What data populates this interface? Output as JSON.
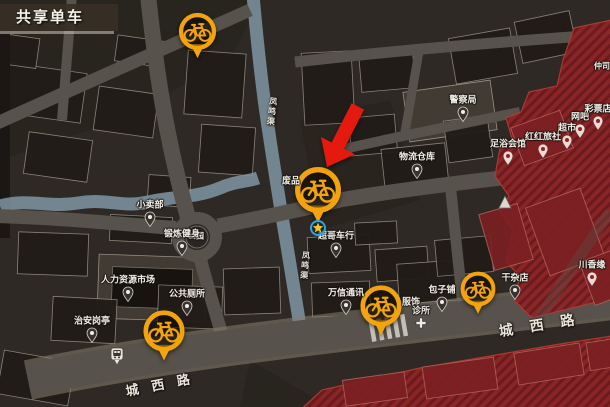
{
  "title": "共享单车",
  "colors": {
    "map_bg": "#2e2925",
    "road": "#57524b",
    "water": "#7e95a3",
    "label_text": "#f2efe9",
    "accent_pin": "#f2a30e",
    "danger_zone": "#8e2428",
    "danger_stripe": "#6f1a1e",
    "arrow_red": "#e41a0f",
    "star_yellow": "#f7c61c",
    "star_ring_blue": "#35a3dc"
  },
  "bike_pins": [
    {
      "x": 197,
      "y": 31,
      "s": 17
    },
    {
      "x": 318,
      "y": 190,
      "s": 21
    },
    {
      "x": 164,
      "y": 331,
      "s": 19
    },
    {
      "x": 381,
      "y": 306,
      "s": 19
    },
    {
      "x": 478,
      "y": 289,
      "s": 16
    }
  ],
  "player_marker": {
    "x": 318,
    "y": 228
  },
  "arrow": {
    "tip_x": 327,
    "tip_y": 167,
    "rotation": 27
  },
  "poi": [
    {
      "label": "警察局",
      "x": 463,
      "y": 121,
      "pin": "dark"
    },
    {
      "label": "物流仓库",
      "x": 417,
      "y": 178,
      "pin": "dark"
    },
    {
      "label": "小卖部",
      "x": 150,
      "y": 226,
      "pin": "dark"
    },
    {
      "label": "公园",
      "x": 196,
      "y": 236,
      "pin": "none",
      "small": true
    },
    {
      "label": "锻炼健身",
      "x": 182,
      "y": 255,
      "pin": "dark"
    },
    {
      "label": "人力资源市场",
      "x": 128,
      "y": 301,
      "pin": "dark"
    },
    {
      "label": "公共厕所",
      "x": 187,
      "y": 315,
      "pin": "dark"
    },
    {
      "label": "治安岗亭",
      "x": 92,
      "y": 342,
      "pin": "dark"
    },
    {
      "label": "超哥车行",
      "x": 336,
      "y": 257,
      "pin": "dark"
    },
    {
      "label": "万信通讯",
      "x": 346,
      "y": 314,
      "pin": "dark"
    },
    {
      "label": "服饰",
      "x": 411,
      "y": 301,
      "pin": "none"
    },
    {
      "label": "诊所",
      "x": 421,
      "y": 322,
      "pin": "cross"
    },
    {
      "label": "包子铺",
      "x": 442,
      "y": 311,
      "pin": "dark"
    },
    {
      "label": "干杂店",
      "x": 515,
      "y": 299,
      "pin": "dark"
    },
    {
      "label": "川香缘",
      "x": 592,
      "y": 286,
      "pin": "light"
    },
    {
      "label": "足浴会馆",
      "x": 508,
      "y": 165,
      "pin": "light"
    },
    {
      "label": "红红旅社",
      "x": 543,
      "y": 158,
      "pin": "light"
    },
    {
      "label": "超市",
      "x": 567,
      "y": 149,
      "pin": "light"
    },
    {
      "label": "网吧",
      "x": 580,
      "y": 138,
      "pin": "light"
    },
    {
      "label": "彩票店",
      "x": 598,
      "y": 130,
      "pin": "light"
    },
    {
      "label": "废品",
      "x": 291,
      "y": 180,
      "pin": "none"
    },
    {
      "label": "仲司",
      "x": 602,
      "y": 66,
      "pin": "none",
      "small": true
    }
  ],
  "street_labels": [
    {
      "text": "城西路",
      "x": 164,
      "y": 383,
      "rot": -11,
      "size": 13,
      "spacing": 13
    },
    {
      "text": "城西路",
      "x": 545,
      "y": 324,
      "rot": -9,
      "size": 14,
      "spacing": 17
    },
    {
      "text": "凤鸣渠",
      "x": 272,
      "y": 112,
      "rot": 7,
      "size": 8,
      "spacing": 2,
      "vertical": true
    },
    {
      "text": "凤鸣渠",
      "x": 305,
      "y": 266,
      "rot": 5,
      "size": 8,
      "spacing": 2,
      "vertical": true
    }
  ],
  "icons": [
    {
      "name": "bus-stop-icon",
      "x": 117,
      "y": 363
    }
  ]
}
